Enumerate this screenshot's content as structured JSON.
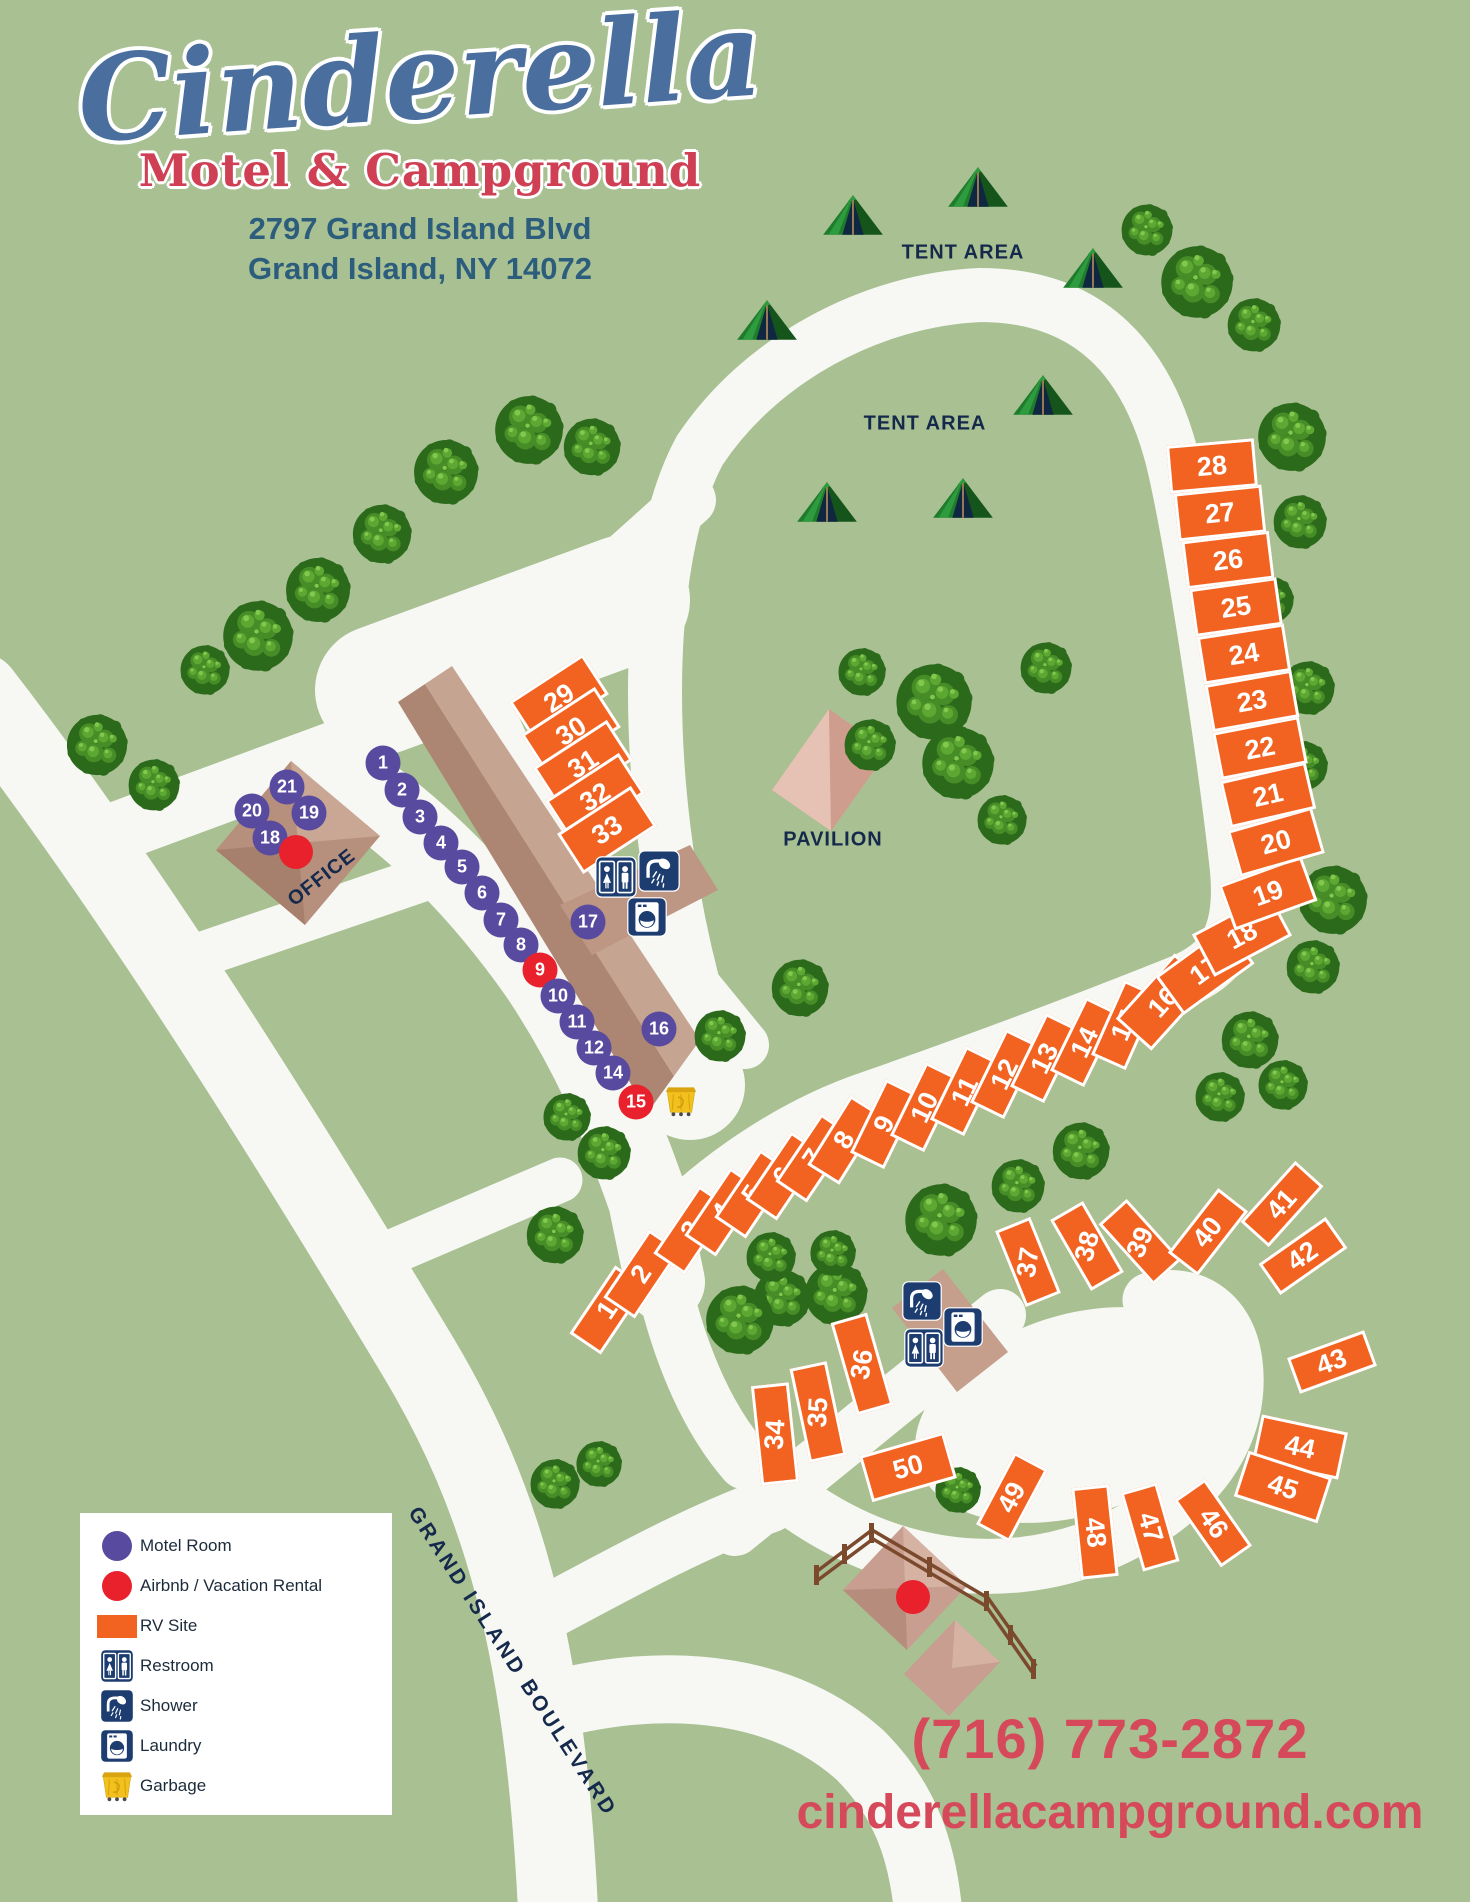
{
  "colors": {
    "bg": "#a8c092",
    "road": "#f7f8f4",
    "rv": "#f26322",
    "motel": "#584a9e",
    "airbnb": "#e8212d",
    "facility": "#1d3d70",
    "navy": "#14294b",
    "logo_blue": "#4a6f9e",
    "logo_red": "#d04055",
    "address_blue": "#2d5d7c",
    "red_text": "#d5495a",
    "building": "#b6907d",
    "pavilion_color": "#d9aa9c",
    "fence": "#7b4a2d",
    "garbage_yellow": "#f2c11d"
  },
  "header": {
    "title": "Cinderella",
    "subtitle": "Motel & Campground",
    "address_line1": "2797 Grand Island Blvd",
    "address_line2": "Grand Island, NY 14072"
  },
  "labels": {
    "tent_area": "TENT AREA",
    "pavilion": "PAVILION",
    "office": "OFFICE",
    "road": "GRAND ISLAND BOULEVARD"
  },
  "contact": {
    "phone": "(716) 773-2872",
    "website": "cinderellacampground.com"
  },
  "legend": {
    "items": [
      {
        "type": "motel",
        "label": "Motel Room"
      },
      {
        "type": "airbnb",
        "label": "Airbnb / Vacation Rental"
      },
      {
        "type": "rv",
        "label": "RV Site"
      },
      {
        "type": "restroom",
        "label": "Restroom"
      },
      {
        "type": "shower",
        "label": "Shower"
      },
      {
        "type": "laundry",
        "label": "Laundry"
      },
      {
        "type": "garbage",
        "label": "Garbage"
      }
    ]
  },
  "map": {
    "tent_area_labels": [
      {
        "x": 963,
        "y": 253
      },
      {
        "x": 925,
        "y": 424
      }
    ],
    "office_label": {
      "x": 322,
      "y": 878,
      "rot": -38
    },
    "pavilion_label": {
      "x": 833,
      "y": 840
    },
    "rv_sites": [
      {
        "n": "1",
        "x": 608,
        "y": 1310,
        "rot": 34,
        "shape": "p",
        "nr": -90
      },
      {
        "n": "2",
        "x": 642,
        "y": 1274,
        "rot": 34,
        "shape": "p",
        "nr": -90
      },
      {
        "n": "3",
        "x": 692,
        "y": 1230,
        "rot": 34,
        "shape": "p",
        "nr": -90
      },
      {
        "n": "4",
        "x": 723,
        "y": 1212,
        "rot": 34,
        "shape": "p",
        "nr": -90
      },
      {
        "n": "5",
        "x": 753,
        "y": 1194,
        "rot": 34,
        "shape": "p",
        "nr": -90
      },
      {
        "n": "6",
        "x": 784,
        "y": 1176,
        "rot": 34,
        "shape": "p",
        "nr": -90
      },
      {
        "n": "7",
        "x": 814,
        "y": 1158,
        "rot": 34,
        "shape": "p",
        "nr": -90
      },
      {
        "n": "8",
        "x": 845,
        "y": 1140,
        "rot": 32,
        "shape": "p",
        "nr": -90
      },
      {
        "n": "9",
        "x": 885,
        "y": 1124,
        "rot": 26,
        "shape": "p",
        "nr": -90
      },
      {
        "n": "10",
        "x": 925,
        "y": 1107,
        "rot": 26,
        "shape": "p",
        "nr": -90
      },
      {
        "n": "11",
        "x": 965,
        "y": 1091,
        "rot": 26,
        "shape": "p",
        "nr": -90
      },
      {
        "n": "12",
        "x": 1005,
        "y": 1074,
        "rot": 26,
        "shape": "p",
        "nr": -90
      },
      {
        "n": "13",
        "x": 1045,
        "y": 1058,
        "rot": 26,
        "shape": "p",
        "nr": -90
      },
      {
        "n": "14",
        "x": 1085,
        "y": 1042,
        "rot": 26,
        "shape": "p",
        "nr": -90
      },
      {
        "n": "15",
        "x": 1125,
        "y": 1025,
        "rot": 24,
        "shape": "p",
        "nr": -90
      },
      {
        "n": "16",
        "x": 1163,
        "y": 1002,
        "rot": -48,
        "shape": "l",
        "nr": 0
      },
      {
        "n": "17",
        "x": 1205,
        "y": 970,
        "rot": -36,
        "shape": "l",
        "nr": 0
      },
      {
        "n": "18",
        "x": 1242,
        "y": 935,
        "rot": -28,
        "shape": "l",
        "nr": 0
      },
      {
        "n": "19",
        "x": 1268,
        "y": 893,
        "rot": -20,
        "shape": "l",
        "nr": 0
      },
      {
        "n": "20",
        "x": 1276,
        "y": 842,
        "rot": -16,
        "shape": "l",
        "nr": 0
      },
      {
        "n": "21",
        "x": 1268,
        "y": 795,
        "rot": -13,
        "shape": "l",
        "nr": 0
      },
      {
        "n": "22",
        "x": 1260,
        "y": 748,
        "rot": -11,
        "shape": "l",
        "nr": 0
      },
      {
        "n": "23",
        "x": 1252,
        "y": 701,
        "rot": -10,
        "shape": "l",
        "nr": 0
      },
      {
        "n": "24",
        "x": 1244,
        "y": 654,
        "rot": -9,
        "shape": "l",
        "nr": 0
      },
      {
        "n": "25",
        "x": 1236,
        "y": 607,
        "rot": -8,
        "shape": "l",
        "nr": 0
      },
      {
        "n": "26",
        "x": 1228,
        "y": 560,
        "rot": -7,
        "shape": "l",
        "nr": 0
      },
      {
        "n": "27",
        "x": 1220,
        "y": 513,
        "rot": -6,
        "shape": "l",
        "nr": 0
      },
      {
        "n": "28",
        "x": 1212,
        "y": 466,
        "rot": -5,
        "shape": "l",
        "nr": 0
      },
      {
        "n": "29",
        "x": 559,
        "y": 698,
        "rot": -33,
        "shape": "l",
        "nr": 0
      },
      {
        "n": "30",
        "x": 571,
        "y": 731,
        "rot": -33,
        "shape": "l",
        "nr": 0
      },
      {
        "n": "31",
        "x": 583,
        "y": 764,
        "rot": -33,
        "shape": "l",
        "nr": 0
      },
      {
        "n": "32",
        "x": 595,
        "y": 797,
        "rot": -33,
        "shape": "l",
        "nr": 0
      },
      {
        "n": "33",
        "x": 607,
        "y": 830,
        "rot": -33,
        "shape": "l",
        "nr": 0
      },
      {
        "n": "34",
        "x": 775,
        "y": 1434,
        "rot": -6,
        "shape": "p",
        "nr": -80,
        "h": 100
      },
      {
        "n": "35",
        "x": 818,
        "y": 1412,
        "rot": -12,
        "shape": "p",
        "nr": -75,
        "h": 96
      },
      {
        "n": "36",
        "x": 862,
        "y": 1364,
        "rot": -16,
        "shape": "p",
        "nr": -65,
        "h": 96
      },
      {
        "n": "37",
        "x": 1028,
        "y": 1262,
        "rot": -22,
        "shape": "p",
        "nr": -60
      },
      {
        "n": "38",
        "x": 1087,
        "y": 1246,
        "rot": -30,
        "shape": "p",
        "nr": -45
      },
      {
        "n": "39",
        "x": 1140,
        "y": 1242,
        "rot": -42,
        "shape": "p",
        "nr": -25
      },
      {
        "n": "40",
        "x": 1208,
        "y": 1232,
        "rot": 38,
        "shape": "p",
        "nr": -90
      },
      {
        "n": "41",
        "x": 1282,
        "y": 1204,
        "rot": 42,
        "shape": "p",
        "nr": -90
      },
      {
        "n": "42",
        "x": 1303,
        "y": 1256,
        "rot": 55,
        "shape": "p",
        "nr": -90
      },
      {
        "n": "43",
        "x": 1332,
        "y": 1362,
        "rot": 70,
        "shape": "p",
        "nr": -90
      },
      {
        "n": "44",
        "x": 1300,
        "y": 1447,
        "rot": 12,
        "shape": "l",
        "nr": 0
      },
      {
        "n": "45",
        "x": 1283,
        "y": 1487,
        "rot": 18,
        "shape": "l",
        "nr": 0
      },
      {
        "n": "46",
        "x": 1213,
        "y": 1523,
        "rot": -35,
        "shape": "p",
        "nr": 90
      },
      {
        "n": "47",
        "x": 1150,
        "y": 1527,
        "rot": -16,
        "shape": "p",
        "nr": 90
      },
      {
        "n": "48",
        "x": 1095,
        "y": 1532,
        "rot": -6,
        "shape": "p",
        "nr": 90,
        "h": 92
      },
      {
        "n": "49",
        "x": 1012,
        "y": 1497,
        "rot": 28,
        "shape": "p",
        "nr": -90
      },
      {
        "n": "50",
        "x": 908,
        "y": 1467,
        "rot": -16,
        "shape": "l",
        "nr": 0
      }
    ],
    "motel_rooms": [
      {
        "n": "1",
        "x": 383,
        "y": 763,
        "type": "m"
      },
      {
        "n": "2",
        "x": 402,
        "y": 790,
        "type": "m"
      },
      {
        "n": "3",
        "x": 420,
        "y": 817,
        "type": "m"
      },
      {
        "n": "4",
        "x": 441,
        "y": 843,
        "type": "m"
      },
      {
        "n": "5",
        "x": 462,
        "y": 867,
        "type": "m"
      },
      {
        "n": "6",
        "x": 482,
        "y": 893,
        "type": "m"
      },
      {
        "n": "7",
        "x": 501,
        "y": 920,
        "type": "m"
      },
      {
        "n": "8",
        "x": 521,
        "y": 945,
        "type": "m"
      },
      {
        "n": "9",
        "x": 540,
        "y": 970,
        "type": "a"
      },
      {
        "n": "10",
        "x": 558,
        "y": 996,
        "type": "m"
      },
      {
        "n": "11",
        "x": 577,
        "y": 1022,
        "type": "m"
      },
      {
        "n": "12",
        "x": 594,
        "y": 1048,
        "type": "m"
      },
      {
        "n": "14",
        "x": 613,
        "y": 1073,
        "type": "m"
      },
      {
        "n": "15",
        "x": 636,
        "y": 1102,
        "type": "a"
      },
      {
        "n": "16",
        "x": 659,
        "y": 1029,
        "type": "m"
      },
      {
        "n": "17",
        "x": 588,
        "y": 922,
        "type": "m"
      },
      {
        "n": "18",
        "x": 270,
        "y": 838,
        "type": "m"
      },
      {
        "n": "19",
        "x": 309,
        "y": 813,
        "type": "m"
      },
      {
        "n": "20",
        "x": 252,
        "y": 811,
        "type": "m"
      },
      {
        "n": "21",
        "x": 287,
        "y": 787,
        "type": "m"
      }
    ],
    "airbnb_dots": [
      {
        "x": 296,
        "y": 852
      },
      {
        "x": 913,
        "y": 1597
      }
    ],
    "facilities": [
      {
        "type": "restroom",
        "x": 616,
        "y": 877,
        "s": 42
      },
      {
        "type": "shower",
        "x": 659,
        "y": 871,
        "s": 42
      },
      {
        "type": "laundry",
        "x": 647,
        "y": 917,
        "s": 40
      },
      {
        "type": "shower",
        "x": 922,
        "y": 1301,
        "s": 40
      },
      {
        "type": "laundry",
        "x": 963,
        "y": 1327,
        "s": 40
      },
      {
        "type": "restroom",
        "x": 924,
        "y": 1348,
        "s": 40
      },
      {
        "type": "garbage",
        "x": 681,
        "y": 1101,
        "s": 38
      }
    ],
    "tents": [
      [
        853,
        215
      ],
      [
        978,
        187
      ],
      [
        1093,
        268
      ],
      [
        767,
        320
      ],
      [
        1043,
        395
      ],
      [
        827,
        502
      ],
      [
        963,
        498
      ]
    ],
    "trees": [
      [
        529,
        430,
        36
      ],
      [
        592,
        447,
        30
      ],
      [
        446,
        472,
        34
      ],
      [
        382,
        534,
        31
      ],
      [
        318,
        590,
        34
      ],
      [
        258,
        636,
        37
      ],
      [
        205,
        670,
        26
      ],
      [
        97,
        745,
        32
      ],
      [
        154,
        785,
        27
      ],
      [
        1147,
        230,
        27
      ],
      [
        1197,
        282,
        38
      ],
      [
        1254,
        325,
        28
      ],
      [
        1292,
        437,
        36
      ],
      [
        1300,
        522,
        28
      ],
      [
        1270,
        600,
        25
      ],
      [
        1308,
        688,
        28
      ],
      [
        1303,
        766,
        26
      ],
      [
        862,
        672,
        25
      ],
      [
        934,
        702,
        40
      ],
      [
        1046,
        668,
        27
      ],
      [
        958,
        763,
        38
      ],
      [
        1002,
        820,
        26
      ],
      [
        870,
        745,
        27
      ],
      [
        800,
        988,
        30
      ],
      [
        720,
        1036,
        27
      ],
      [
        1333,
        900,
        36
      ],
      [
        1313,
        967,
        28
      ],
      [
        1250,
        1040,
        30
      ],
      [
        1283,
        1085,
        26
      ],
      [
        1220,
        1097,
        26
      ],
      [
        941,
        1220,
        38
      ],
      [
        1018,
        1186,
        28
      ],
      [
        1081,
        1151,
        30
      ],
      [
        836,
        1294,
        33
      ],
      [
        782,
        1298,
        30
      ],
      [
        771,
        1257,
        26
      ],
      [
        833,
        1253,
        24
      ],
      [
        740,
        1320,
        36
      ],
      [
        567,
        1117,
        25
      ],
      [
        604,
        1153,
        28
      ],
      [
        555,
        1235,
        30
      ],
      [
        555,
        1484,
        26
      ],
      [
        599,
        1464,
        24
      ],
      [
        958,
        1490,
        24
      ]
    ]
  }
}
